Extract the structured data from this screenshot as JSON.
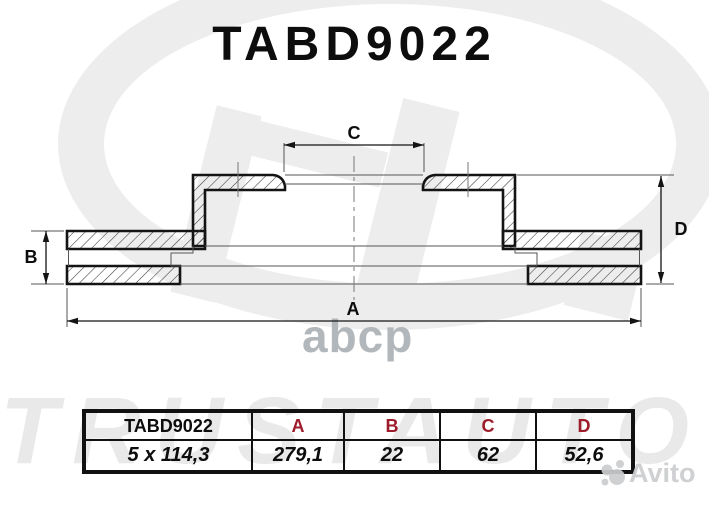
{
  "title": "TABD9022",
  "drawing": {
    "dim_a": "A",
    "dim_b": "B",
    "dim_c": "C",
    "dim_d": "D"
  },
  "table": {
    "part_number": "TABD9022",
    "fitment": "5 x 114,3",
    "headers": [
      "A",
      "B",
      "C",
      "D"
    ],
    "values": [
      "279,1",
      "22",
      "62",
      "52,6"
    ]
  },
  "watermarks": {
    "brand": "TRUSTAUTO",
    "distributor": "abcp",
    "marketplace": "Avito"
  },
  "colors": {
    "table_header_accent": "#9e1b2b",
    "line_color": "#141414",
    "watermark_light": "#ededed",
    "watermark_mid": "#b2b7bb"
  }
}
